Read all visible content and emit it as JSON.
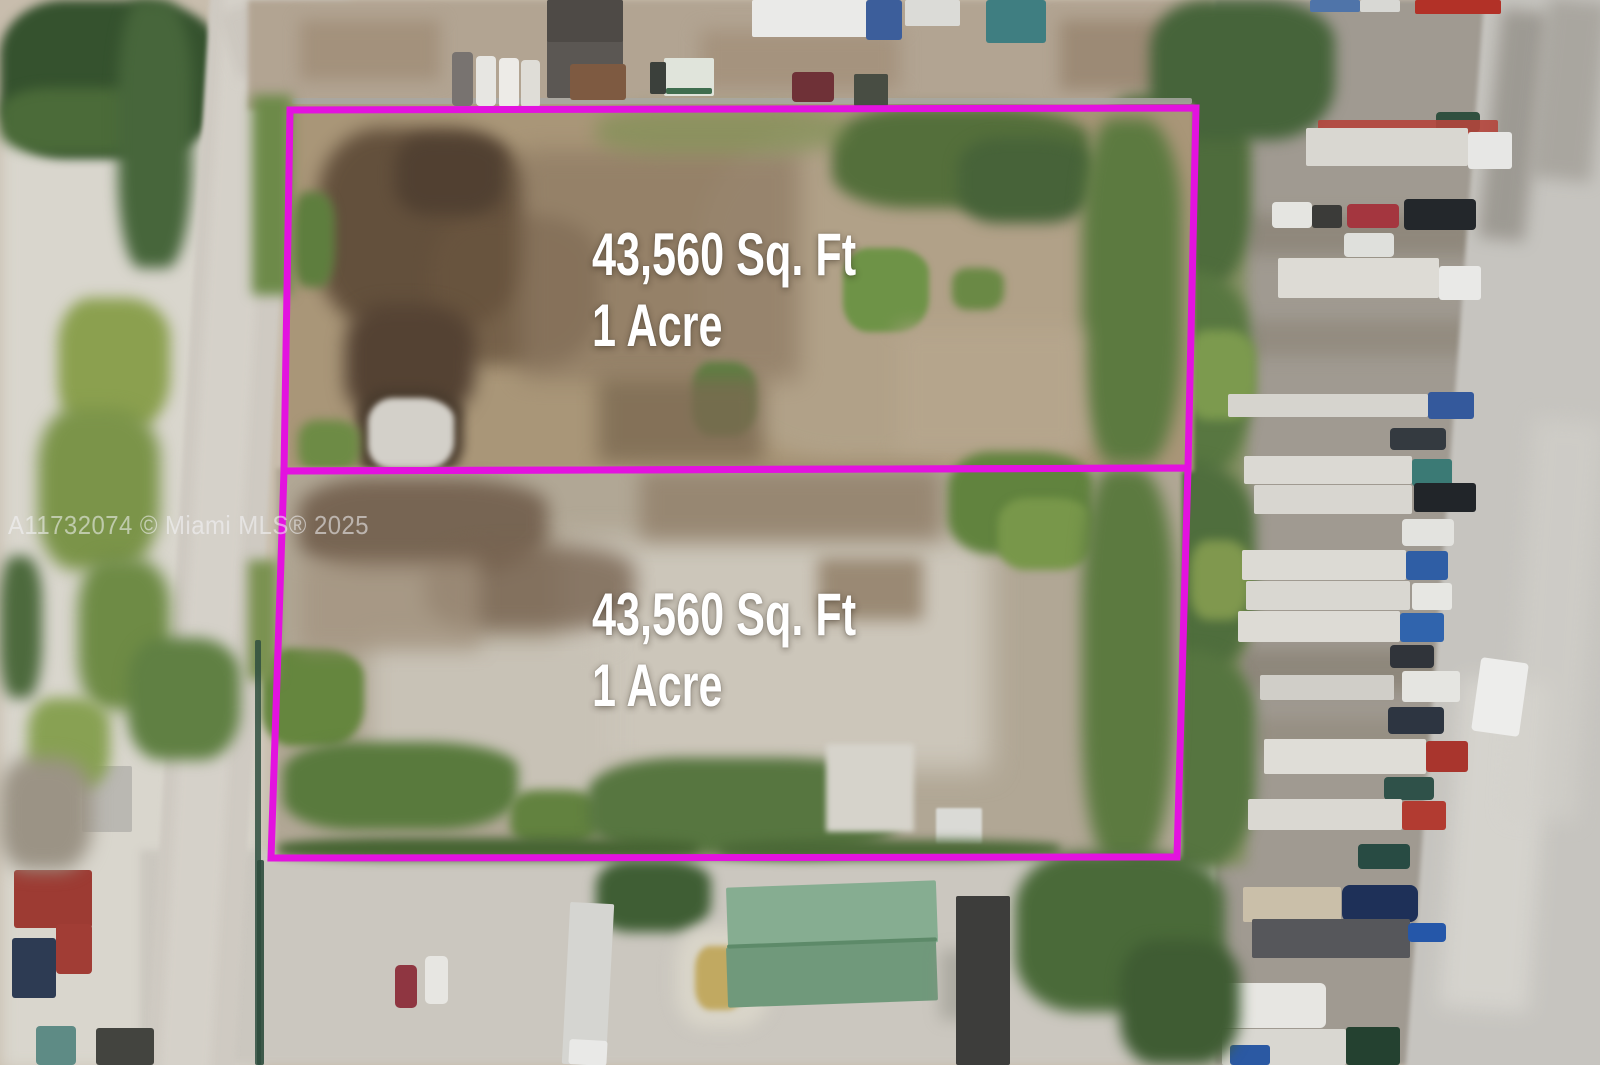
{
  "photo": {
    "watermark": "A11732074 © Miami MLS® 2025",
    "outline_color": "#E312DF",
    "label_color": "#FFFFFF",
    "parcels": [
      {
        "area_label": "43,560 Sq. Ft",
        "acre_label": "1 Acre"
      },
      {
        "area_label": "43,560 Sq. Ft",
        "acre_label": "1 Acre"
      }
    ]
  }
}
